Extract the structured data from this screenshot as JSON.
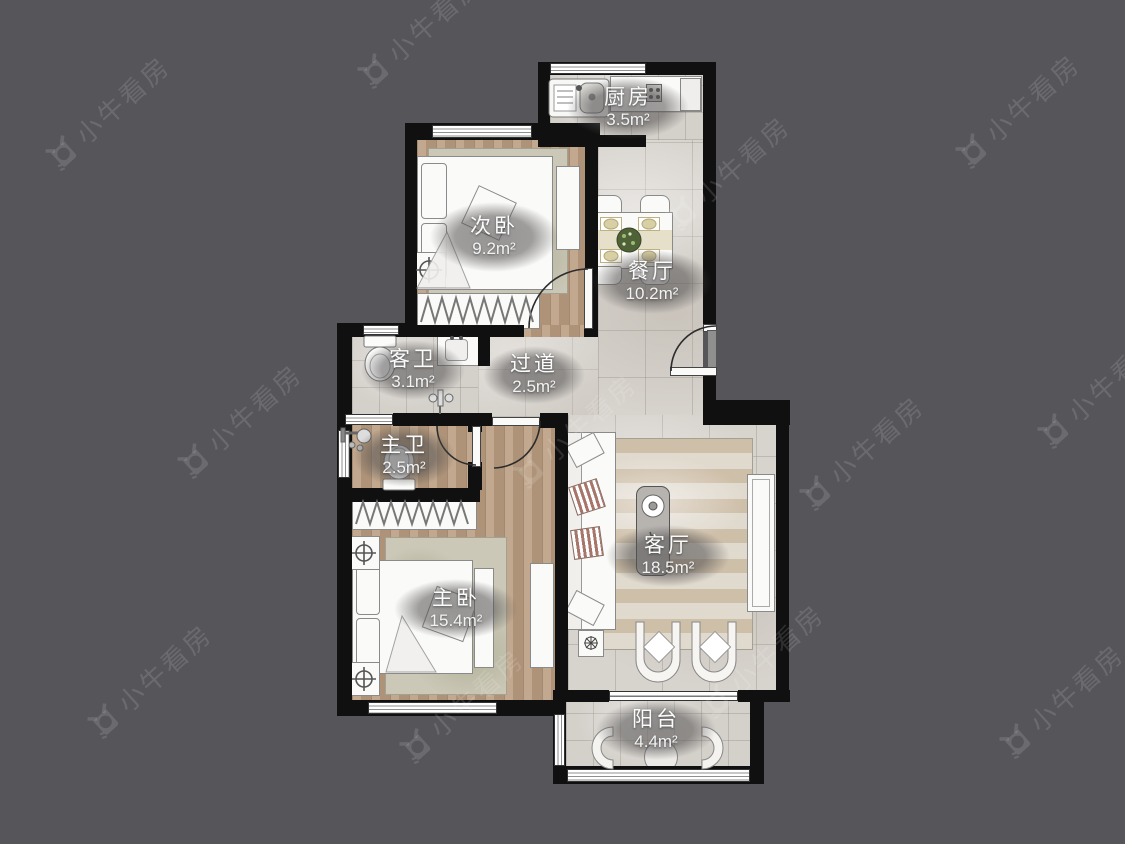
{
  "brand": {
    "watermark": "小牛看房"
  },
  "colors": {
    "background": "#56565a",
    "wall": "#101010",
    "tile_floor": "#d7d3cd",
    "wood_floor": "#bb9e81",
    "label_bubble": "rgba(82,80,80,0.58)",
    "label_text": "#fbfbfb",
    "watermark": "rgba(255,255,255,0.13)"
  },
  "rooms": [
    {
      "id": "kitchen",
      "name": "厨房",
      "area": "3.5m²"
    },
    {
      "id": "secondary-bedroom",
      "name": "次卧",
      "area": "9.2m²"
    },
    {
      "id": "dining-room",
      "name": "餐厅",
      "area": "10.2m²"
    },
    {
      "id": "guest-bathroom",
      "name": "客卫",
      "area": "3.1m²"
    },
    {
      "id": "hallway",
      "name": "过道",
      "area": "2.5m²"
    },
    {
      "id": "master-bathroom",
      "name": "主卫",
      "area": "2.5m²"
    },
    {
      "id": "living-room",
      "name": "客厅",
      "area": "18.5m²"
    },
    {
      "id": "master-bedroom",
      "name": "主卧",
      "area": "15.4m²"
    },
    {
      "id": "balcony",
      "name": "阳台",
      "area": "4.4m²"
    }
  ]
}
